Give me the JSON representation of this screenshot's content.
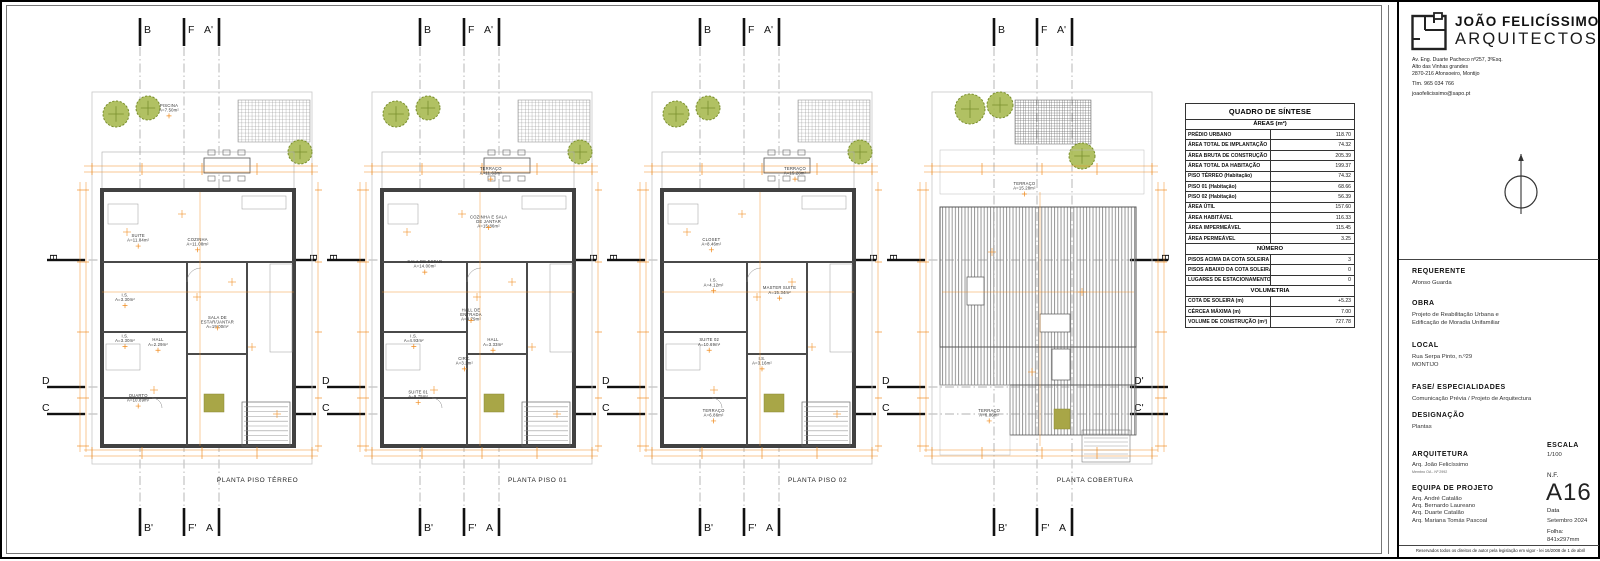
{
  "firm": {
    "name_bold": "JOÃO FELICÍSSIMO",
    "name_light": "ARQUITECTOS",
    "address_lines": [
      "Av. Eng. Duarte Pacheco nº257, 3ºEsq.",
      "Alto das Vinhas grandes",
      "2870-216 Afonsoeiro, Montijo"
    ],
    "phone": "Tlm. 965 034 766",
    "email": "joaofelicissimo@sapo.pt"
  },
  "title_block": {
    "sections": [
      {
        "label": "REQUERENTE",
        "lines": [
          "Afonso Guarda"
        ]
      },
      {
        "label": "OBRA",
        "lines": [
          "Projeto de Reabilitação Urbana e",
          "Edificação de Moradia Unifamiliar"
        ]
      },
      {
        "label": "LOCAL",
        "lines": [
          "Rua Serpa Pinto, n.º29",
          "MONTIJO"
        ]
      },
      {
        "label": "FASE/ ESPECIALIDADES",
        "lines": [
          "Comunicação Prévia / Projeto de Arquitectura"
        ]
      },
      {
        "label": "DESIGNAÇÃO",
        "lines": [
          "Plantas"
        ]
      }
    ],
    "arquitetura_label": "ARQUITETURA",
    "arquitetura_name": "Arq. João Felicíssimo",
    "arquitetura_reg": "Membro OA - Nº 2992",
    "equipa_label": "EQUIPA DE PROJETO",
    "equipa_lines": [
      "Arq. André Catalão",
      "Arq. Bernardo Laureano",
      "Arq. Duarte Catalão",
      "Arq. Mariana Tomás Pascoal"
    ],
    "escala_label": "ESCALA",
    "escala_value": "1/100",
    "nf_label": "N.F.",
    "nf_value": "A16",
    "data_label": "Data",
    "data_value": "Setembro 2024",
    "folha_label": "Folha:",
    "folha_value": "841x297mm",
    "copyright": "Reservados todos os direitos de autor pela legislação em vigor - lei 16/2008 de 1 de abril"
  },
  "quadro": {
    "title": "QUADRO DE SÍNTESE",
    "groups": [
      {
        "header": "ÁREAS (m²)",
        "rows": [
          [
            "PRÉDIO URBANO",
            "118.70"
          ],
          [
            "ÁREA TOTAL DE IMPLANTAÇÃO",
            "74.32"
          ],
          [
            "ÁREA BRUTA DE CONSTRUÇÃO",
            "205.39"
          ],
          [
            "ÁREA TOTAL DA HABITAÇÃO",
            "199.37"
          ],
          [
            "PISO TÉRREO (Habitação)",
            "74.32"
          ],
          [
            "PISO 01 (Habitação)",
            "68.66"
          ],
          [
            "PISO 02 (Habitação)",
            "56.39"
          ],
          [
            "ÁREA ÚTIL",
            "157.60"
          ],
          [
            "ÁREA HABITÁVEL",
            "116.33"
          ],
          [
            "ÁREA IMPERMEÁVEL",
            "115.45"
          ],
          [
            "ÁREA PERMEÁVEL",
            "3.25"
          ]
        ]
      },
      {
        "header": "NÚMERO",
        "rows": [
          [
            "PISOS ACIMA DA COTA SOLEIRA",
            "3"
          ],
          [
            "PISOS ABAIXO DA COTA SOLEIRA",
            "0"
          ],
          [
            "LUGARES DE ESTACIONAMENTO",
            "0"
          ]
        ]
      },
      {
        "header": "VOLUMETRIA",
        "rows": [
          [
            "COTA DE SOLEIRA (m)",
            "+5.23"
          ],
          [
            "CÉRCEA MÁXIMA (m)",
            "7.00"
          ],
          [
            "VOLUME DE CONSTRUÇÃO (m³)",
            "727.78"
          ]
        ]
      }
    ]
  },
  "plans": [
    {
      "title": "PLANTA PISO TÉRREO",
      "type": "floor",
      "markers": {
        "top": [
          "B",
          "F",
          "A'"
        ],
        "bottom": [
          "B'",
          "F'",
          "A"
        ],
        "left": [
          "E",
          "D",
          "C"
        ],
        "right": [
          "E",
          "D'",
          "C'"
        ]
      },
      "rooms": [
        {
          "n": "PISCINA",
          "a": "A=7.50m²",
          "x": 35,
          "y": 4
        },
        {
          "n": "SUITE",
          "a": "A=11.84m²",
          "x": 21,
          "y": 39
        },
        {
          "n": "COZINHA",
          "a": "A=11.08m²",
          "x": 48,
          "y": 40
        },
        {
          "n": "I.S.",
          "a": "A=3.30m²",
          "x": 15,
          "y": 55
        },
        {
          "n": "SALA DE ESTAR/JANTAR",
          "a": "A=19.00m²",
          "x": 57,
          "y": 61
        },
        {
          "n": "I.S.",
          "a": "A=3.30m²",
          "x": 15,
          "y": 66
        },
        {
          "n": "HALL",
          "a": "A=2.29m²",
          "x": 30,
          "y": 67
        },
        {
          "n": "QUARTO",
          "a": "A=10.89m²",
          "x": 21,
          "y": 82
        }
      ]
    },
    {
      "title": "PLANTA PISO 01",
      "type": "floor",
      "markers": {
        "top": [
          "B",
          "F",
          "A'"
        ],
        "bottom": [
          "B'",
          "F'",
          "A"
        ],
        "left": [
          "E",
          "D",
          "C"
        ],
        "right": [
          "E",
          "D'",
          "C'"
        ]
      },
      "rooms": [
        {
          "n": "TERRAÇO",
          "a": "A=11.63m²",
          "x": 54,
          "y": 21
        },
        {
          "n": "COZINHA E SALA DE JANTAR",
          "a": "A=15.86m²",
          "x": 53,
          "y": 34
        },
        {
          "n": "SALA DE ESTAR",
          "a": "A=14.00m²",
          "x": 24,
          "y": 46
        },
        {
          "n": "HALL DE ENTRADA",
          "a": "A=4.79m²",
          "x": 45,
          "y": 59
        },
        {
          "n": "I.S.",
          "a": "A=4.93m²",
          "x": 19,
          "y": 66
        },
        {
          "n": "HALL",
          "a": "A=3.33m²",
          "x": 55,
          "y": 67
        },
        {
          "n": "CIRC.",
          "a": "A=3.2m²",
          "x": 42,
          "y": 72
        },
        {
          "n": "SUITE 01",
          "a": "A=9.75m²",
          "x": 21,
          "y": 81
        }
      ]
    },
    {
      "title": "PLANTA PISO 02",
      "type": "floor",
      "markers": {
        "top": [
          "B",
          "F",
          "A'"
        ],
        "bottom": [
          "B'",
          "F'",
          "A"
        ],
        "left": [
          "E",
          "D",
          "C"
        ],
        "right": [
          "E",
          "D'",
          "C'"
        ]
      },
      "rooms": [
        {
          "n": "TERRAÇO",
          "a": "A=15.28m²",
          "x": 65,
          "y": 21
        },
        {
          "n": "CLOSET",
          "a": "A=8.46m²",
          "x": 27,
          "y": 40
        },
        {
          "n": "I.S.",
          "a": "A=4.12m²",
          "x": 28,
          "y": 51
        },
        {
          "n": "MASTER SUITE",
          "a": "A=15.34m²",
          "x": 58,
          "y": 53
        },
        {
          "n": "SUITE 02",
          "a": "A=10.69m²",
          "x": 26,
          "y": 67
        },
        {
          "n": "I.S.",
          "a": "A=3.16m²",
          "x": 50,
          "y": 72
        },
        {
          "n": "TERRAÇO",
          "a": "A=6.86m²",
          "x": 28,
          "y": 86
        }
      ]
    },
    {
      "title": "PLANTA COBERTURA",
      "type": "roof",
      "markers": {
        "top": [
          "B",
          "F",
          "A'"
        ],
        "bottom": [
          "B'",
          "F'",
          "A"
        ],
        "left": [
          "E",
          "D",
          "C"
        ],
        "right": [
          "E",
          "D'",
          "C'"
        ]
      },
      "rooms": [
        {
          "n": "TERRAÇO",
          "a": "A=15.28m²",
          "x": 42,
          "y": 25
        },
        {
          "n": "TERRAÇO",
          "a": "A=6.86m²",
          "x": 26,
          "y": 86
        }
      ]
    }
  ],
  "colors": {
    "dimension": "#f08a1c",
    "wall": "#414141",
    "tree_fill": "#a9ba52",
    "tree_stroke": "#7a8f2e",
    "olive": "#a8a647",
    "hatch": "#8c8c8c"
  }
}
